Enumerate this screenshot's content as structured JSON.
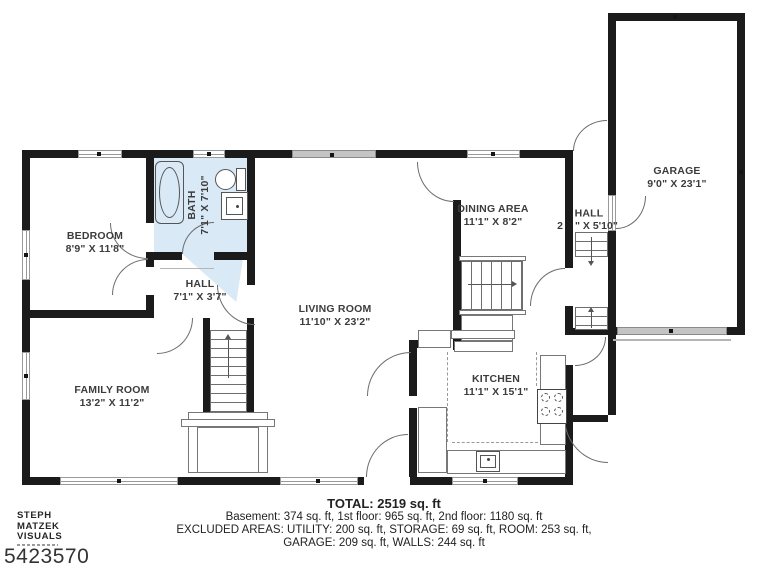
{
  "meta": {
    "photo_id": "5423570",
    "watermark_lines": [
      "STEPH",
      "MATZEK",
      "VISUALS"
    ],
    "disclaimer": "DIMENSIONS ARE APPROXIMATE; ACTUAL MAY VARY"
  },
  "rooms": [
    {
      "id": "bedroom",
      "name": "BEDROOM",
      "dims": "8'9\" X 11'8\""
    },
    {
      "id": "bath",
      "name": "BATH",
      "dims": "7'1\" X 7'10\""
    },
    {
      "id": "hall",
      "name": "HALL",
      "dims": "7'1\" X 3'7\""
    },
    {
      "id": "family-room",
      "name": "FAMILY ROOM",
      "dims": "13'2\" X 11'2\""
    },
    {
      "id": "living-room",
      "name": "LIVING ROOM",
      "dims": "11'10\" X 23'2\""
    },
    {
      "id": "dining-area",
      "name": "DINING AREA",
      "dims": "11'1\" X 8'2\""
    },
    {
      "id": "hall-2",
      "name": "HALL",
      "dims_left": "2",
      "dims_right": "\" X 5'10\""
    },
    {
      "id": "kitchen",
      "name": "KITCHEN",
      "dims": "11'1\" X 15'1\""
    },
    {
      "id": "garage",
      "name": "GARAGE",
      "dims": "9'0\" X 23'1\""
    }
  ],
  "summary": {
    "total": "TOTAL: 2519 sq. ft",
    "line1": "Basement: 374 sq. ft, 1st floor: 965 sq. ft, 2nd floor: 1180 sq. ft",
    "line2": "EXCLUDED AREAS: UTILITY: 200 sq. ft, STORAGE: 69 sq. ft, ROOM: 253 sq. ft,",
    "line3": "GARAGE: 209 sq. ft, WALLS: 244 sq. ft"
  },
  "colors": {
    "wall": "#1b1b1b",
    "bath_fill": "#d9e9f6",
    "window_gray": "#c4c4c4",
    "line": "#6b6b6b",
    "text": "#3c3c3c"
  }
}
